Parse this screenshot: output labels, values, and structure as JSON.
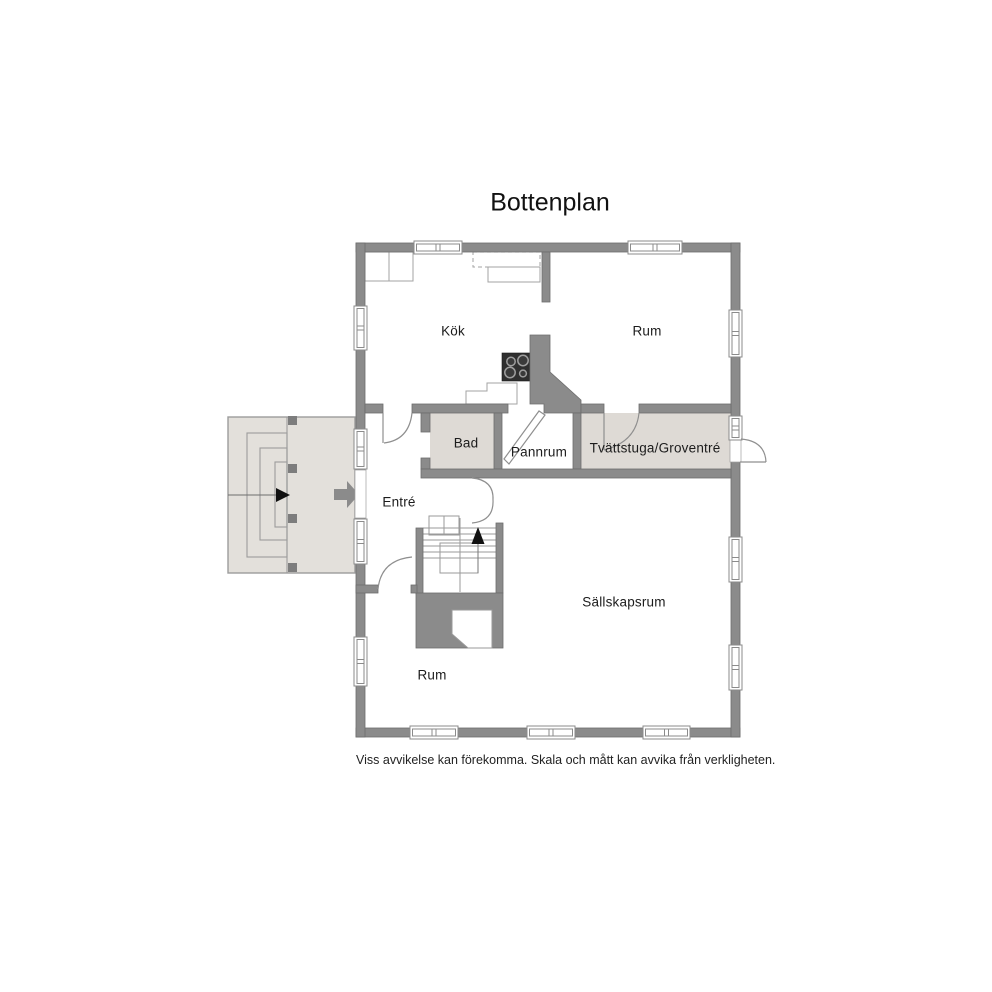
{
  "title": "Bottenplan",
  "disclaimer": "Viss avvikelse kan förekomma. Skala och mått kan avvika från verkligheten.",
  "rooms": {
    "kitchen": "Kök",
    "room_top_right": "Rum",
    "bathroom": "Bad",
    "boiler_room": "Pannrum",
    "laundry_utility_entry": "Tvättstuga/Groventré",
    "entry": "Entré",
    "living_room": "Sällskapsrum",
    "room_bottom_left": "Rum"
  },
  "icons": {
    "stove": "stove-icon",
    "staircase": "staircase-icon",
    "stair_direction_arrow": "up-arrow-icon",
    "entrance_arrow": "entrance-arrow-icon",
    "porch_step_arrow": "step-arrow-icon",
    "window": "window-icon",
    "door_swing": "door-swing-icon"
  },
  "colors": {
    "background": "#ffffff",
    "wall": "#8b8b8b",
    "wall_outline": "#6d6d6d",
    "room_fill": "#dedad5",
    "porch_fill": "#e3e0db",
    "fixture_outline": "#a3a3a3",
    "stove_body": "#2f2f2f",
    "text": "#1c1c1c"
  }
}
